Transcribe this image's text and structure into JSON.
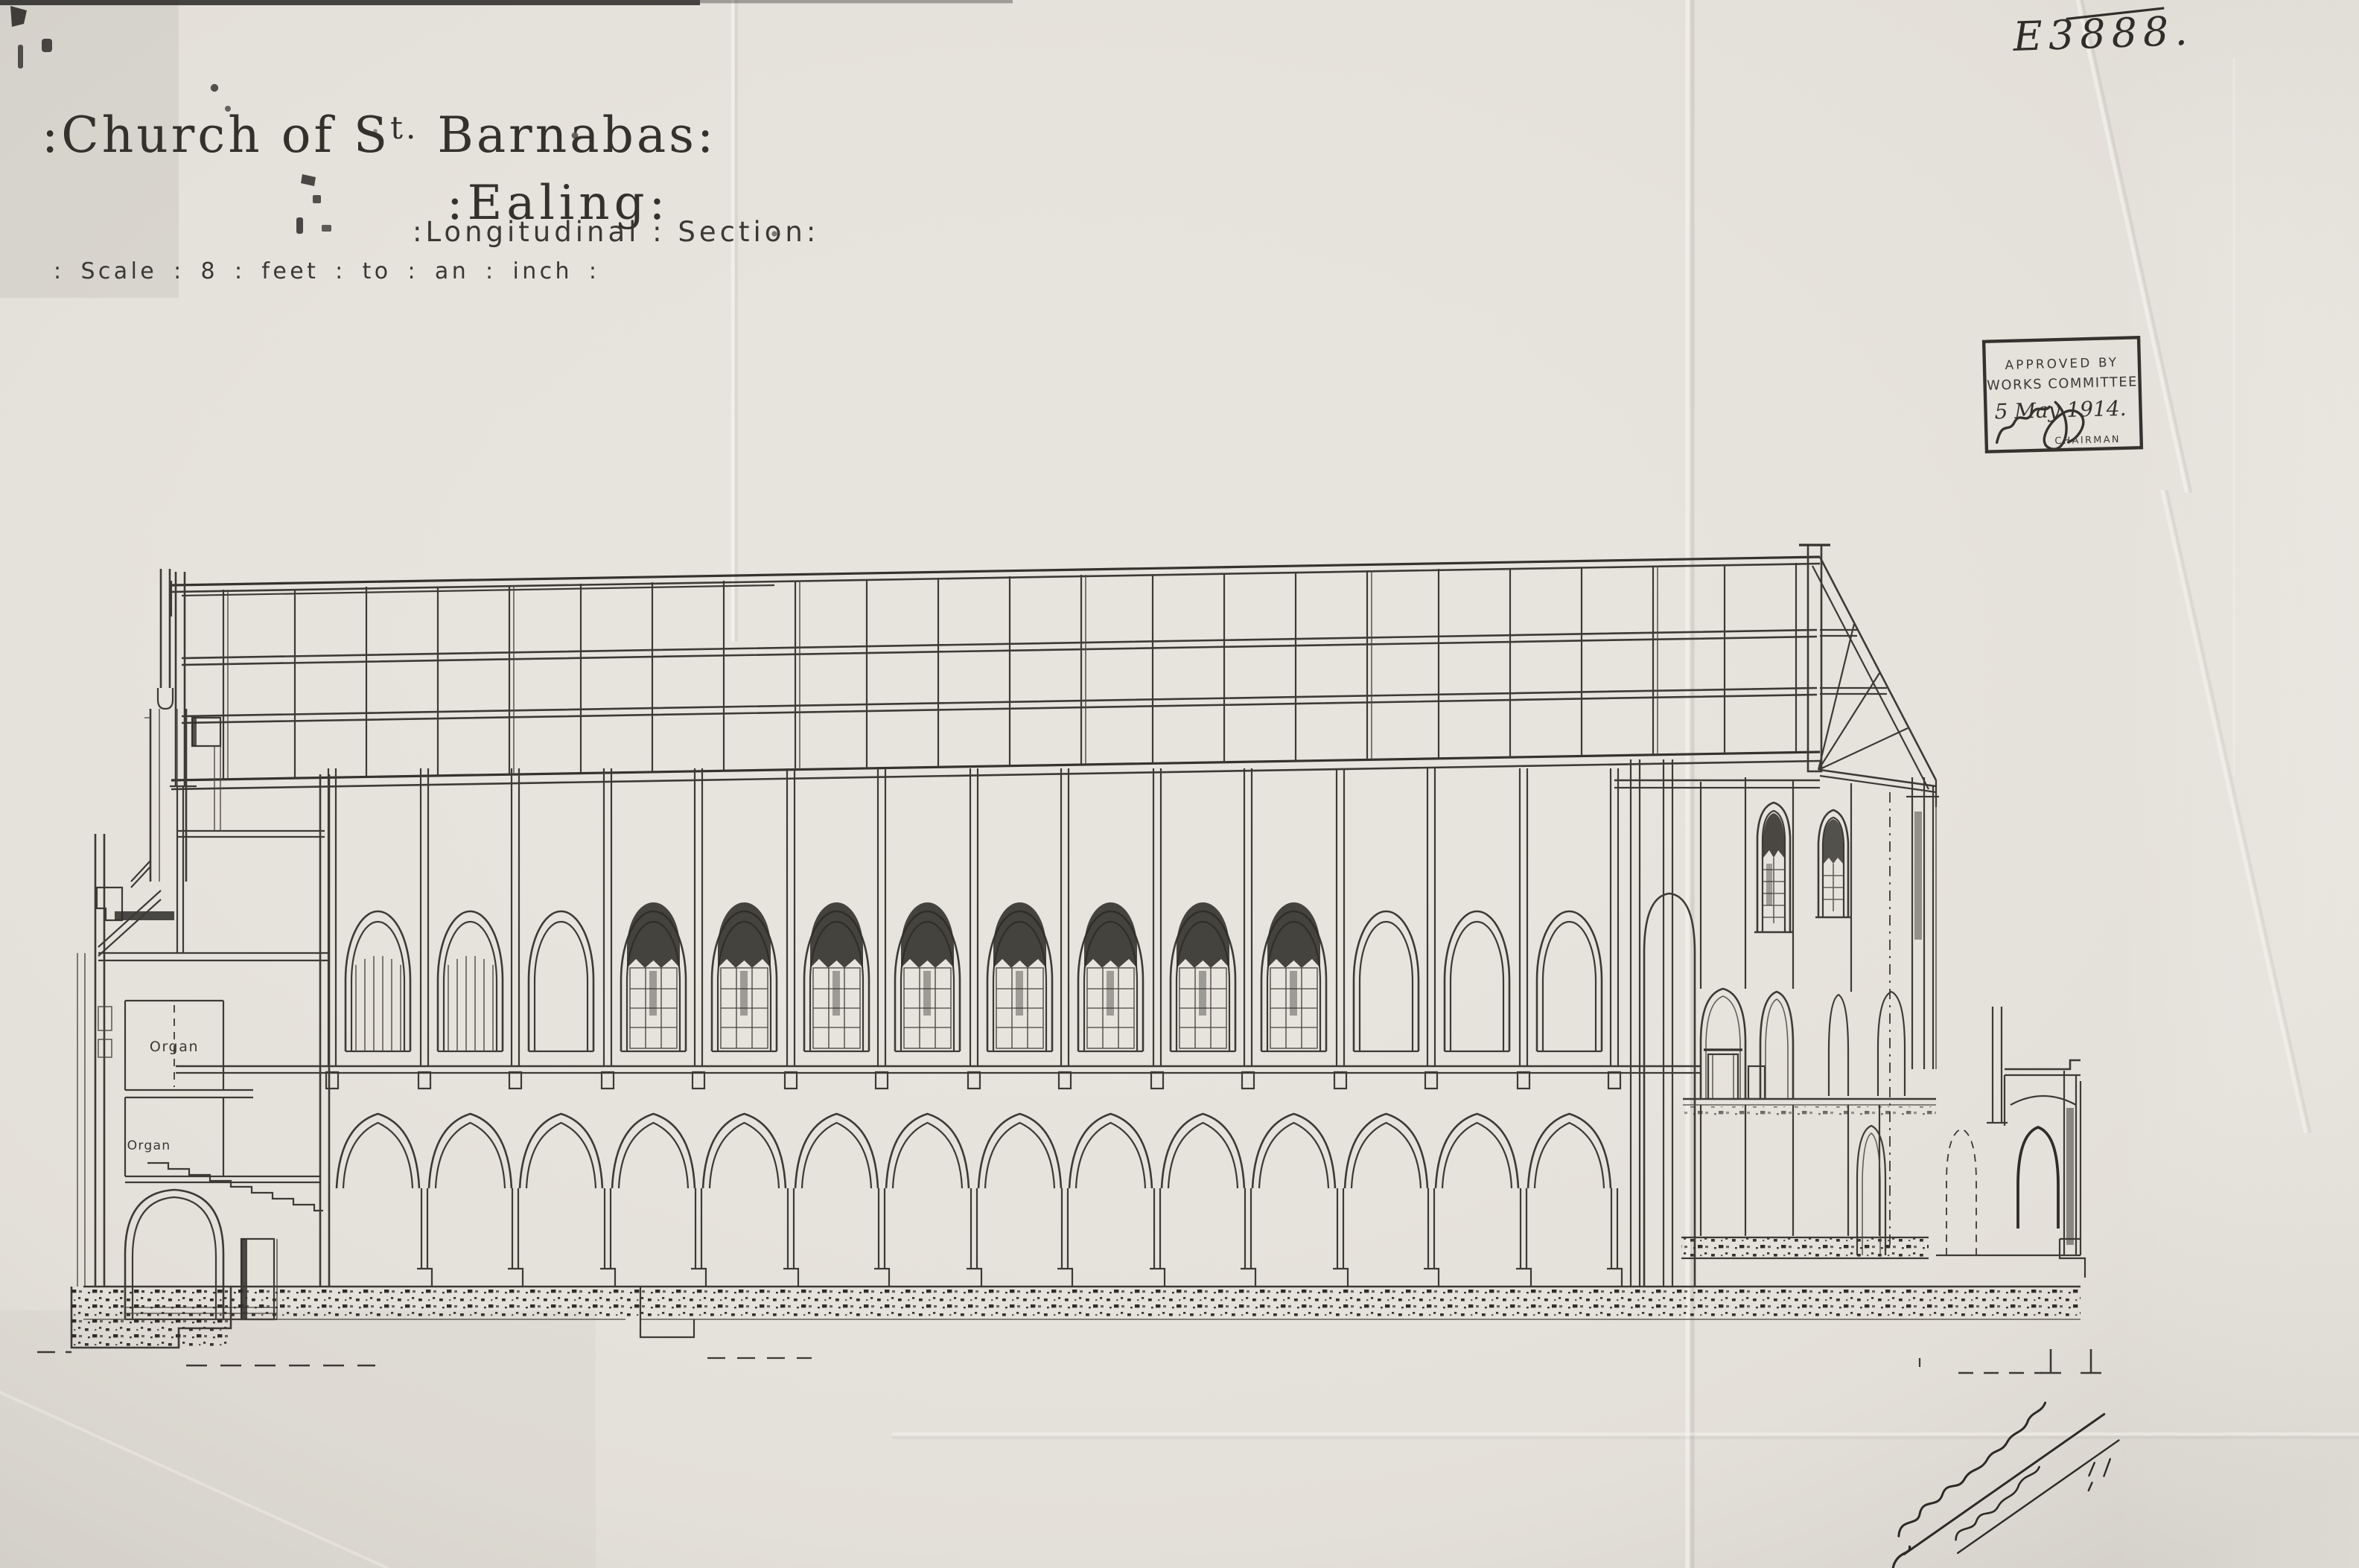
{
  "document": {
    "reference_number": "E3888.",
    "title": {
      "prefix": ":Church of S",
      "superscript": "t.",
      "suffix": " Barnabas:",
      "line2": ":Ealing:",
      "line3": ":Longitudinal : Section:",
      "scale_note": ": Scale : 8 : feet : to : an : inch :"
    },
    "approval_stamp": {
      "line1": "APPROVED BY",
      "line2": "WORKS COMMITTEE",
      "date": "5 May 1914.",
      "chairman_label": "CHAIRMAN"
    },
    "drawing_labels": {
      "organ_upper": "Organ",
      "organ_lower": "Organ"
    },
    "ink_color": "#3a3833",
    "paper_color": "#e7e4dd"
  }
}
